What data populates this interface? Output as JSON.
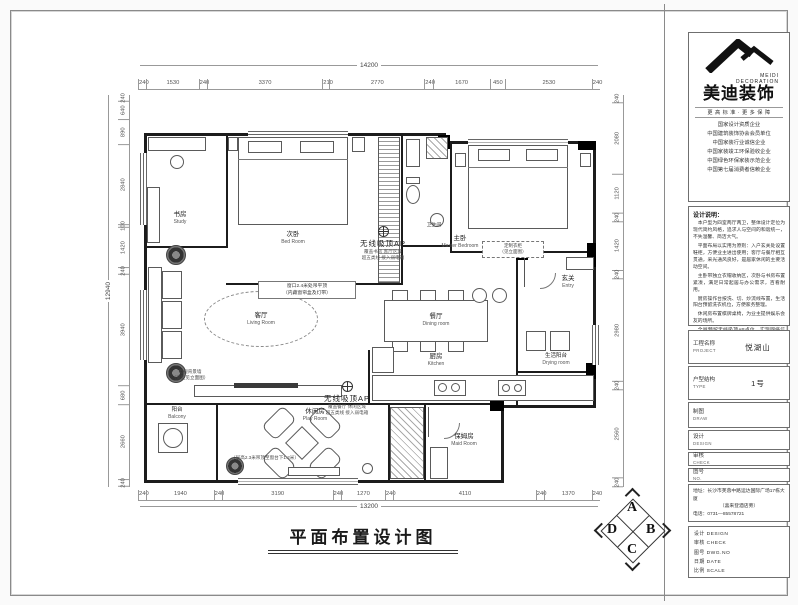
{
  "sheet": {
    "title": "平面布置设计图"
  },
  "brand": {
    "zh": "美迪装饰",
    "en_line1": "MEIDI",
    "en_line2": "DECORATION",
    "tagline": "更 高 标 准 · 更 多 保 障",
    "credentials": [
      "国家设计资质企业",
      "中国建筑装饰协会会员单位",
      "中国家装行业诚信企业",
      "中国家装竣工环保验收企业",
      "中国绿色环保家装示范企业",
      "中国第七届消费者信赖企业"
    ]
  },
  "notes": {
    "header": "设计说明：",
    "paragraphs": [
      "本户型为四室两厅两卫，整体设计定位为现代简约风格，追求人与空间的和谐统一，不失温馨、简洁大气。",
      "平面布局以实用为原则：入户玄关处设置鞋柜，方便业主进出使用；客厅与餐厅相互贯通，采光通风良好，是居家休闲的主要活动空间。",
      "主卧带独立衣帽收纳区，次卧与书房布置紧凑，满足日常起居与办公需求，百看耐用。",
      "厨房操作台按洗、切、炒流线布置，生活阳台预留洗衣机位，方便家务整理。",
      "休闲房布置棋牌桌椅，为业主提供娱乐会友的场所。",
      "全屋预留无线吸顶AP点位，实现网络信号全覆盖。"
    ]
  },
  "fields": [
    {
      "label": "工程名称",
      "sub": "PROJECT",
      "value": "悦湖山"
    },
    {
      "label": "户型结构",
      "sub": "TYPE",
      "value": "1号"
    },
    {
      "label": "制图",
      "sub": "DRAW",
      "value": ""
    },
    {
      "label": "设计",
      "sub": "DESIGN",
      "value": ""
    },
    {
      "label": "审核",
      "sub": "CHECK",
      "value": ""
    },
    {
      "label": "图号",
      "sub": "NO.",
      "value": ""
    }
  ],
  "contact": {
    "addr1": "地址：长沙市芙蓉中路运达国际广场17栋大厦",
    "addr2": "（喜来登酒店旁）",
    "phone": "电话：0731—85578721"
  },
  "approval": [
    "设计 DESIGN",
    "审核 CHECK",
    "图号 DWG.NO",
    "日期 DATE",
    "比例 SCALE"
  ],
  "compass": {
    "top": "A",
    "right": "B",
    "bottom": "C",
    "left": "D"
  },
  "rooms": {
    "study": {
      "zh": "书房",
      "en": "Study"
    },
    "bedroom": {
      "zh": "次卧",
      "en": "Bed Room"
    },
    "master": {
      "zh": "主卧",
      "en": "Master Bedroom"
    },
    "bath": {
      "zh": "卫生间",
      "en": ""
    },
    "living": {
      "zh": "客厅",
      "en": "Living Room"
    },
    "dining": {
      "zh": "餐厅",
      "en": "Dining room"
    },
    "kitchen": {
      "zh": "厨房",
      "en": "Kitchen"
    },
    "entry": {
      "zh": "玄关",
      "en": "Entry"
    },
    "drying": {
      "zh": "生活阳台",
      "en": "Drying room"
    },
    "balcony": {
      "zh": "阳台",
      "en": "Balcony"
    },
    "leisure": {
      "zh": "休闲房",
      "en": "Play Room"
    },
    "maid": {
      "zh": "保姆房",
      "en": "Maid Room"
    }
  },
  "annotations": {
    "ap1_title": "无线吸顶AP",
    "ap1_l1": "覆盖书房 客厅区域",
    "ap1_l2": "超五类线 接入弱电箱",
    "ap2_title": "无线吸顶AP",
    "ap2_l1": "覆盖餐厅 休闲区域",
    "ap2_l2": "超五类线 接入弱电箱",
    "ceiling_note_1": "窗口2.4米处吊平顶",
    "ceiling_note_2": "（内藏窗帘盒及灯带）",
    "tv_note_1": "电视背景墙",
    "tv_note_2": "（造型见立面图）",
    "beam_note": "（层高2.3米吊顶至窗台下1.2米）",
    "wardrobe_note_1": "定制衣柜",
    "wardrobe_note_2": "（见立面图）"
  },
  "dims": {
    "top": {
      "overall": "14200",
      "segments": [
        "240",
        "1530",
        "240",
        "3370",
        "210",
        "2770",
        "240",
        "1670",
        "450",
        "2530",
        "240"
      ]
    },
    "bottom": {
      "overall": "13200",
      "segments": [
        "240",
        "1940",
        "240",
        "3190",
        "240",
        "1270",
        "240",
        "4110",
        "240",
        "1370",
        "240"
      ]
    },
    "left": {
      "overall": "12940",
      "segments": [
        "240",
        "640",
        "890",
        "2840",
        "100",
        "1420",
        "240",
        "3940",
        "680",
        "2660",
        "240"
      ]
    },
    "right": {
      "segments": [
        "240",
        "2080",
        "1120",
        "240",
        "1420",
        "240",
        "2980",
        "240",
        "2560",
        "240"
      ]
    }
  }
}
